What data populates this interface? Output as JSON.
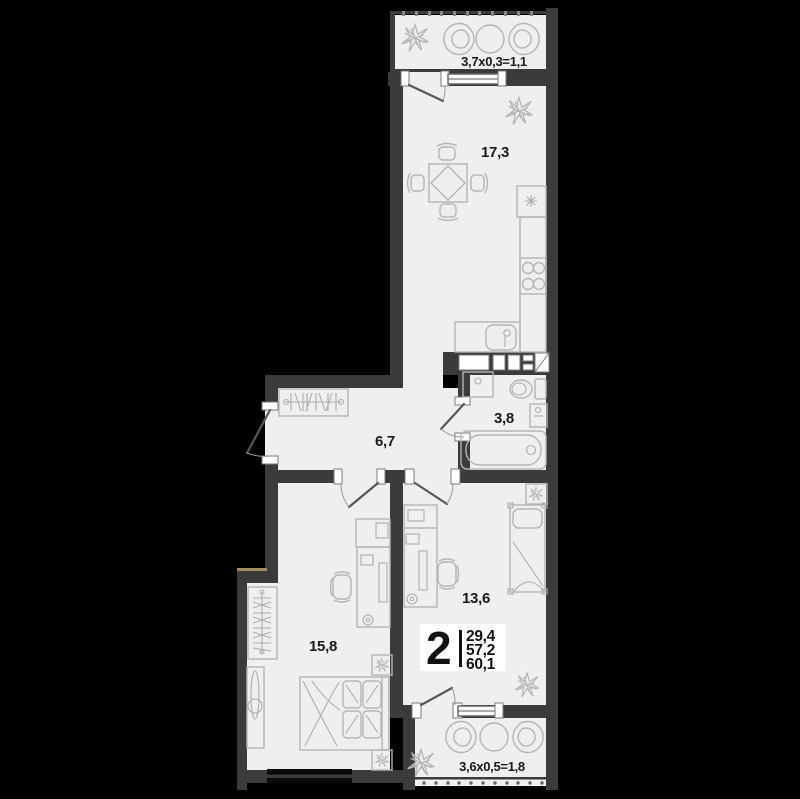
{
  "plan_title": "2-room apartment floor plan",
  "rooms": {
    "balcony_top": {
      "label": "3,7x0,3=1,1"
    },
    "kitchen_living": {
      "label": "17,3"
    },
    "bathroom": {
      "label": "3,8"
    },
    "hallway": {
      "label": "6,7"
    },
    "bedroom_small": {
      "label": "13,6"
    },
    "bedroom_large": {
      "label": "15,8"
    },
    "balcony_bottom": {
      "label": "3,6x0,5=1,8"
    }
  },
  "info_badge": {
    "rooms_count": "2",
    "areas": [
      "29,4",
      "57,2",
      "60,1"
    ]
  },
  "colors": {
    "background": "#000000",
    "walls": "#3b3b3b",
    "floor": "#efefef",
    "furniture_lines": "#b5b5b5",
    "label_text": "#1a1a1a",
    "badge_background": "#ffffff",
    "step_accent": "#9d8d60"
  }
}
